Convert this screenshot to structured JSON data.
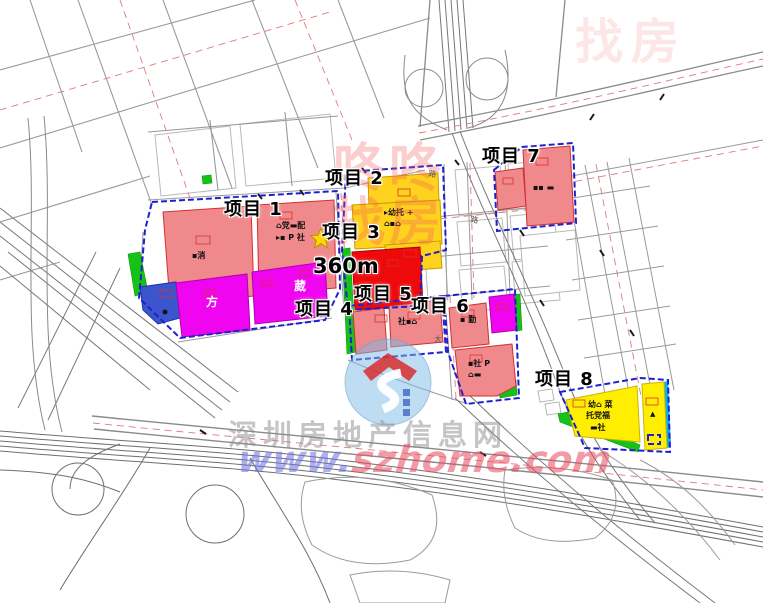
{
  "projects": {
    "p1": "项目 1",
    "p2": "项目 2",
    "p3": "项目 3",
    "p4": "项目 4",
    "p5": "项目 5",
    "p6": "项目 6",
    "p7": "项目 7",
    "p8": "项目 8"
  },
  "distance_marker": "360m",
  "watermarks": {
    "stamp_chars": [
      "咚",
      "咚",
      "找",
      "房"
    ],
    "site_name": "深圳房地产信息网",
    "url_www": "www.",
    "url_domain": "szhome.com"
  },
  "parcel_labels": {
    "p1_left_icons": "▪消",
    "p1_right_icons_1": "⌂党▬配",
    "p1_right_icons_2": "▸▪ P 社",
    "magenta_left": "方",
    "magenta_right": "葳",
    "p2_icons_1": "▸幼托 +",
    "p2_icons_2": "⌂▪⌂",
    "p5_icons": "社▪⌂",
    "p6_icons": "▪ 勤",
    "p6_south_icons_1": "▪社 P",
    "p6_south_icons_2": "⌂▬",
    "p7_icons": "▪▪ ▬",
    "p8_icons_1": "幼⌂ 菜",
    "p8_icons_2": "托党福",
    "p8_icons_3": "▬社",
    "p8_person": "▲"
  },
  "road_labels": [
    "路",
    "路",
    "大"
  ],
  "colors": {
    "parcel_pink": "#f0898b",
    "parcel_magenta": "#f005f0",
    "parcel_yellow_gold": "#ffd21e",
    "parcel_yellow_bright": "#ffee00",
    "parcel_red": "#ee0a0a",
    "parcel_blue": "#3b55cc",
    "strip_green": "#17c217",
    "strip_cyan": "#00b7e8",
    "boundary_blue": "#1f1fd0",
    "road_gray": "#9a9a9a",
    "centerline_red": "#e07a7a"
  }
}
